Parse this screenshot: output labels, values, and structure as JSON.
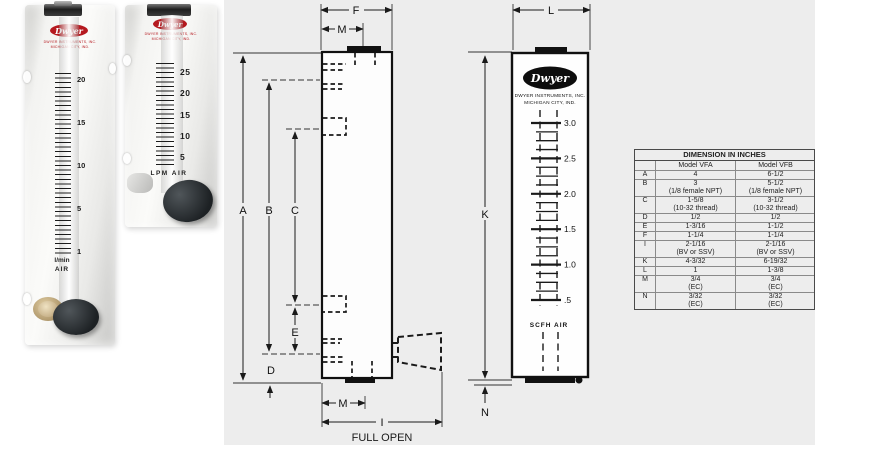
{
  "colors": {
    "dwyer_red": "#b5191f",
    "panel_gray": "#ededed",
    "line_black": "#1a1a1a"
  },
  "brand": {
    "name": "Dwyer",
    "mfr_line1": "DWYER INSTRUMENTS, INC.",
    "mfr_line2": "MICHIGAN CITY, IND."
  },
  "photos": {
    "vfb": {
      "scale": [
        "20",
        "15",
        "10",
        "5",
        "1"
      ],
      "unit_line1": "l/min",
      "unit_line2": "AIR"
    },
    "vfa": {
      "scale": [
        "25",
        "20",
        "15",
        "10",
        "5"
      ],
      "unit": "LPM AIR"
    }
  },
  "side_view": {
    "labels": {
      "A": "A",
      "B": "B",
      "C": "C",
      "D": "D",
      "E": "E",
      "F": "F",
      "I": "I",
      "M_top": "M",
      "M_bottom": "M"
    },
    "full_open": "FULL OPEN"
  },
  "front_view": {
    "labels": {
      "K": "K",
      "L": "L",
      "N": "N"
    },
    "scale": [
      "3.0",
      "2.5",
      "2.0",
      "1.5",
      "1.0",
      ".5"
    ],
    "unit": "SCFH AIR"
  },
  "table": {
    "title": "DIMENSION IN INCHES",
    "col_vfa": "Model VFA",
    "col_vfb": "Model VFB",
    "rows": [
      {
        "label": "A",
        "vfa1": "4",
        "vfa2": "",
        "vfb1": "6-1/2",
        "vfb2": ""
      },
      {
        "label": "B",
        "vfa1": "3",
        "vfa2": "(1/8 female NPT)",
        "vfb1": "5-1/2",
        "vfb2": "(1/8 female NPT)"
      },
      {
        "label": "C",
        "vfa1": "1-5/8",
        "vfa2": "(10-32 thread)",
        "vfb1": "3-1/2",
        "vfb2": "(10-32 thread)"
      },
      {
        "label": "D",
        "vfa1": "1/2",
        "vfa2": "",
        "vfb1": "1/2",
        "vfb2": ""
      },
      {
        "label": "E",
        "vfa1": "1-3/16",
        "vfa2": "",
        "vfb1": "1-1/2",
        "vfb2": ""
      },
      {
        "label": "F",
        "vfa1": "1-1/4",
        "vfa2": "",
        "vfb1": "1-1/4",
        "vfb2": ""
      },
      {
        "label": "I",
        "vfa1": "2-1/16",
        "vfa2": "(BV or SSV)",
        "vfb1": "2-1/16",
        "vfb2": "(BV or SSV)"
      },
      {
        "label": "K",
        "vfa1": "4-3/32",
        "vfa2": "",
        "vfb1": "6-19/32",
        "vfb2": ""
      },
      {
        "label": "L",
        "vfa1": "1",
        "vfa2": "",
        "vfb1": "1-3/8",
        "vfb2": ""
      },
      {
        "label": "M",
        "vfa1": "3/4",
        "vfa2": "(EC)",
        "vfb1": "3/4",
        "vfb2": "(EC)"
      },
      {
        "label": "N",
        "vfa1": "3/32",
        "vfa2": "(EC)",
        "vfb1": "3/32",
        "vfb2": "(EC)"
      }
    ]
  }
}
